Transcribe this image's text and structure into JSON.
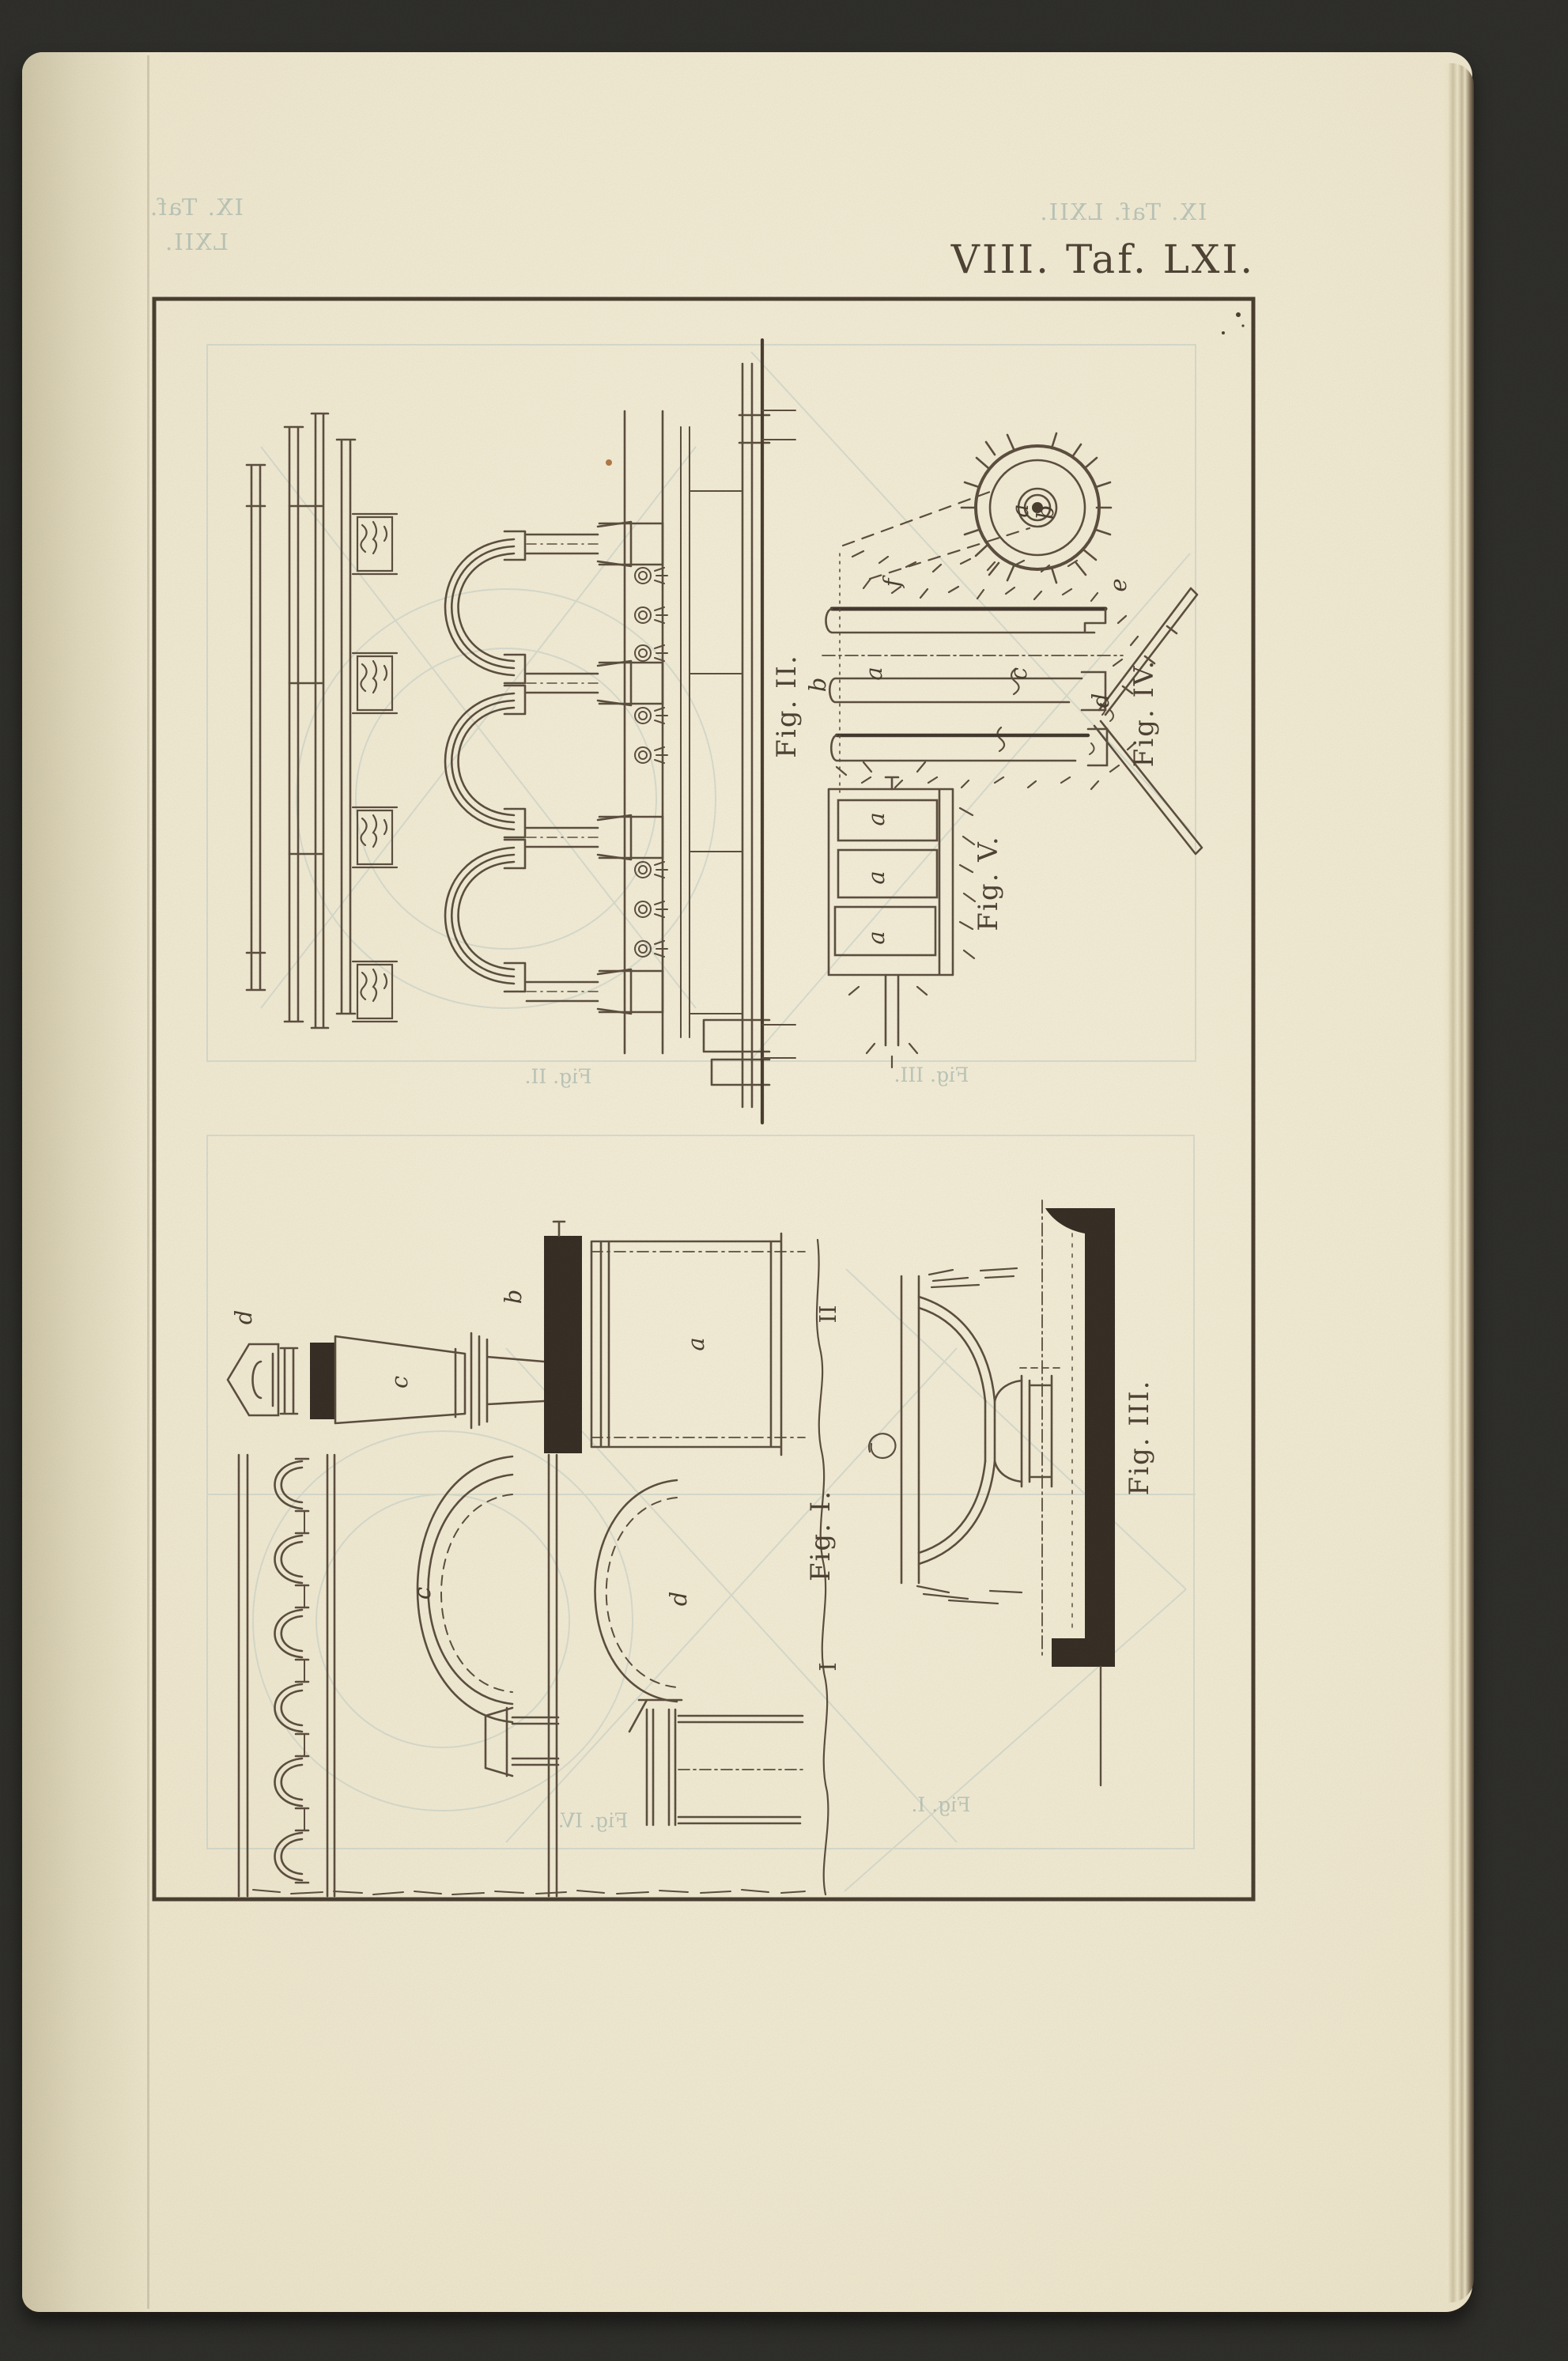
{
  "plate": {
    "title": "VIII. Taf. LXI."
  },
  "showthrough": {
    "title_left": "IX. Taf. LXII.",
    "title_right": "IX. Taf. LXII.",
    "labels": {
      "upper_left": "Fig. II.",
      "upper_right": "Fig. III.",
      "lower_left": "Fig. IV.",
      "lower_right": "Fig. I."
    }
  },
  "figures": {
    "fig1": {
      "label": "Fig. I.",
      "strip": {
        "d": "d",
        "c": "c",
        "b": "b",
        "a": "a"
      },
      "arcade": {
        "c": "c",
        "d": "d"
      },
      "markers": {
        "upper": "II",
        "lower": "I"
      }
    },
    "fig2": {
      "label": "Fig. II."
    },
    "fig3": {
      "label": "Fig. III."
    },
    "fig4": {
      "label": "Fig. IV.",
      "letters": {
        "f": "f",
        "b": "b",
        "a": "a",
        "c": "c",
        "d": "d",
        "e": "e"
      },
      "wheel": {
        "a": "a",
        "b": "b"
      }
    },
    "fig5": {
      "label": "Fig. V.",
      "cells": [
        "a",
        "a",
        "a"
      ]
    }
  },
  "colors": {
    "background": "#2a2a27",
    "paper": "#f4eed7",
    "ink": "#55483a",
    "ink_dark": "#352c21",
    "showthrough": "#b7c8c3",
    "rust_speck": "#a4622c"
  }
}
